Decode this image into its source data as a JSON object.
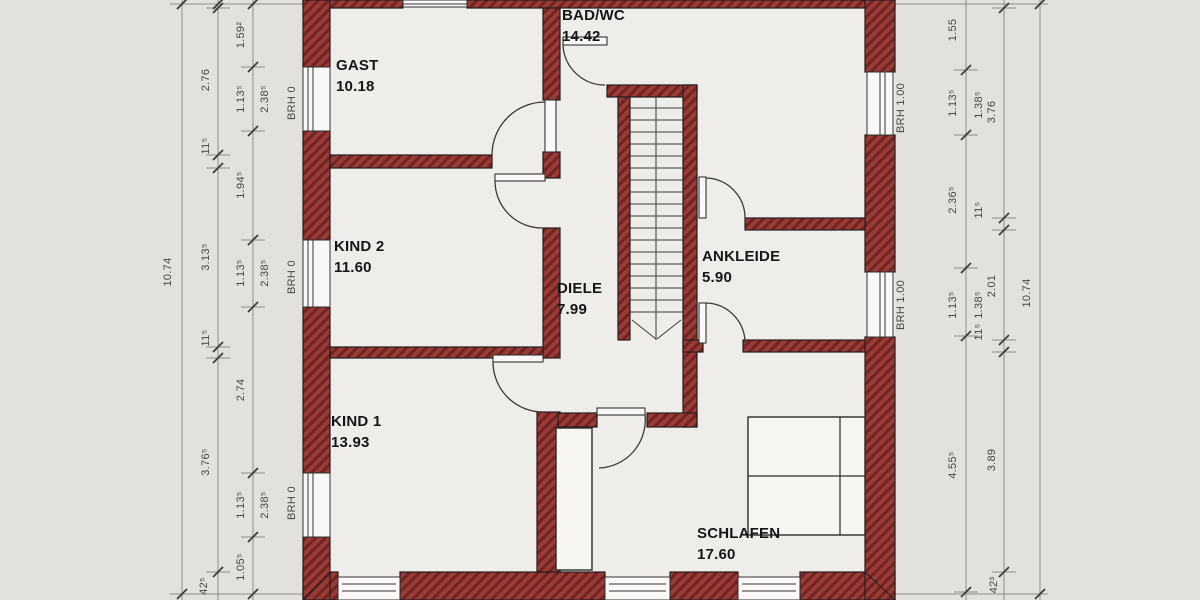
{
  "title": "Obergeschoss Grundriss (floor plan)",
  "colors": {
    "paper": "#e3e1dd",
    "floor": "#efede9",
    "wall_fill": "#9a3b37",
    "wall_hatch": "#702522",
    "wall_outline": "#241d20",
    "dim_line": "#8f8d89",
    "dim_text": "#474645",
    "label_text": "#161616"
  },
  "rooms": [
    {
      "name": "GAST",
      "area": "10.18",
      "x": 336,
      "y": 55
    },
    {
      "name": "BAD/WC",
      "area": "14.42",
      "x": 562,
      "y": 5
    },
    {
      "name": "KIND 2",
      "area": "11.60",
      "x": 334,
      "y": 236
    },
    {
      "name": "DIELE",
      "area": "7.99",
      "x": 557,
      "y": 278
    },
    {
      "name": "ANKLEIDE",
      "area": "5.90",
      "x": 702,
      "y": 246
    },
    {
      "name": "KIND 1",
      "area": "13.93",
      "x": 331,
      "y": 411
    },
    {
      "name": "SCHLAFEN",
      "area": "17.60",
      "x": 697,
      "y": 523
    }
  ],
  "dim_labels": [
    {
      "t": "10.74",
      "x": 168,
      "y": 272
    },
    {
      "t": "2.76",
      "x": 206,
      "y": 80
    },
    {
      "t": "11⁵",
      "x": 206,
      "y": 146
    },
    {
      "t": "3.13⁵",
      "x": 206,
      "y": 257
    },
    {
      "t": "11⁵",
      "x": 206,
      "y": 338
    },
    {
      "t": "3.76⁵",
      "x": 206,
      "y": 462
    },
    {
      "t": "42⁵",
      "x": 204,
      "y": 586
    },
    {
      "t": "1.59²",
      "x": 241,
      "y": 35
    },
    {
      "t": "1.13⁵",
      "x": 241,
      "y": 99
    },
    {
      "t": "1.94⁵",
      "x": 241,
      "y": 185
    },
    {
      "t": "1.13⁵",
      "x": 241,
      "y": 273
    },
    {
      "t": "2.74",
      "x": 241,
      "y": 390
    },
    {
      "t": "1.13⁵",
      "x": 241,
      "y": 505
    },
    {
      "t": "1.05⁵",
      "x": 241,
      "y": 567
    },
    {
      "t": "2.38⁵",
      "x": 265,
      "y": 99
    },
    {
      "t": "2.38⁵",
      "x": 265,
      "y": 273
    },
    {
      "t": "2.38⁵",
      "x": 265,
      "y": 505
    },
    {
      "t": "BRH 0",
      "x": 292,
      "y": 103
    },
    {
      "t": "BRH 0",
      "x": 292,
      "y": 277
    },
    {
      "t": "BRH 0",
      "x": 292,
      "y": 503
    },
    {
      "t": "BRH 1.00",
      "x": 901,
      "y": 108
    },
    {
      "t": "BRH 1.00",
      "x": 901,
      "y": 305
    },
    {
      "t": "1.55",
      "x": 953,
      "y": 30
    },
    {
      "t": "1.13⁵",
      "x": 953,
      "y": 103
    },
    {
      "t": "2.36⁵",
      "x": 953,
      "y": 200
    },
    {
      "t": "1.13⁵",
      "x": 953,
      "y": 305
    },
    {
      "t": "4.55⁵",
      "x": 953,
      "y": 465
    },
    {
      "t": "1.38⁵",
      "x": 979,
      "y": 105
    },
    {
      "t": "11⁵",
      "x": 979,
      "y": 210
    },
    {
      "t": "1.38⁵",
      "x": 979,
      "y": 305
    },
    {
      "t": "11⁵",
      "x": 979,
      "y": 332
    },
    {
      "t": "3.76",
      "x": 992,
      "y": 112
    },
    {
      "t": "2.01",
      "x": 992,
      "y": 286
    },
    {
      "t": "3.89",
      "x": 992,
      "y": 460
    },
    {
      "t": "42³",
      "x": 994,
      "y": 585
    },
    {
      "t": "10.74",
      "x": 1027,
      "y": 293
    }
  ]
}
